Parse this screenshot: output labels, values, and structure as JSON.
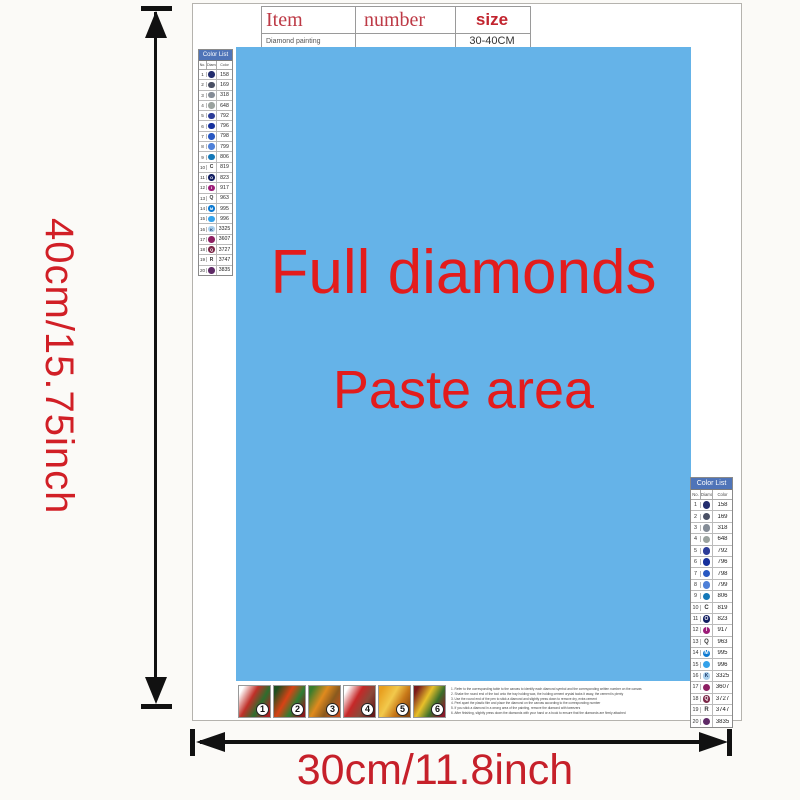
{
  "dimensions": {
    "vertical": "40cm/15.75inch",
    "horizontal": "30cm/11.8inch"
  },
  "item_table": {
    "headers": [
      "Item",
      "number",
      "size"
    ],
    "row": {
      "item": "Diamond painting",
      "number": "",
      "size": "30-40CM"
    }
  },
  "paste_area": {
    "line1": "Full diamonds",
    "line2": "Paste area",
    "bg_color": "#65b3e8",
    "text_color": "#e31c1c"
  },
  "color_list": {
    "title": "Color List",
    "header_bg": "#4f74b8",
    "columns": [
      "No.",
      "Diamond",
      "Color"
    ],
    "rows": [
      {
        "no": "1",
        "code": "158",
        "dot": "#232d6e",
        "glyph": "",
        "glyph_color": "#ffffff"
      },
      {
        "no": "2",
        "code": "169",
        "dot": "#4a5064",
        "glyph": "",
        "glyph_color": "#ffffff"
      },
      {
        "no": "3",
        "code": "318",
        "dot": "#848c96",
        "glyph": "",
        "glyph_color": "#ffffff"
      },
      {
        "no": "4",
        "code": "648",
        "dot": "#9aa29e",
        "glyph": "",
        "glyph_color": "#ffffff"
      },
      {
        "no": "5",
        "code": "792",
        "dot": "#2c3c98",
        "glyph": "",
        "glyph_color": "#ffffff"
      },
      {
        "no": "6",
        "code": "796",
        "dot": "#16309c",
        "glyph": "",
        "glyph_color": "#ffffff"
      },
      {
        "no": "7",
        "code": "798",
        "dot": "#2858c2",
        "glyph": "",
        "glyph_color": "#ffffff"
      },
      {
        "no": "8",
        "code": "799",
        "dot": "#4e80d8",
        "glyph": "",
        "glyph_color": "#ffffff"
      },
      {
        "no": "9",
        "code": "806",
        "dot": "#1478b8",
        "glyph": "",
        "glyph_color": "#ffffff"
      },
      {
        "no": "10",
        "code": "819",
        "dot": "",
        "glyph": "C",
        "glyph_color": "#333333"
      },
      {
        "no": "11",
        "code": "823",
        "dot": "#121f62",
        "glyph": "O",
        "glyph_color": "#ffffff"
      },
      {
        "no": "12",
        "code": "917",
        "dot": "#9c1c78",
        "glyph": "I",
        "glyph_color": "#ffffff"
      },
      {
        "no": "13",
        "code": "963",
        "dot": "",
        "glyph": "Q",
        "glyph_color": "#333333"
      },
      {
        "no": "14",
        "code": "995",
        "dot": "#0c7ad2",
        "glyph": "M",
        "glyph_color": "#ffffff"
      },
      {
        "no": "15",
        "code": "996",
        "dot": "#34a2ea",
        "glyph": "",
        "glyph_color": "#ffffff"
      },
      {
        "no": "16",
        "code": "3325",
        "dot": "#a9cfec",
        "glyph": "K",
        "glyph_color": "#1a3a6a"
      },
      {
        "no": "17",
        "code": "3607",
        "dot": "#8e2062",
        "glyph": "",
        "glyph_color": "#ffffff"
      },
      {
        "no": "18",
        "code": "3727",
        "dot": "#7c2848",
        "glyph": "Q",
        "glyph_color": "#ffffff"
      },
      {
        "no": "19",
        "code": "3747",
        "dot": "",
        "glyph": "R",
        "glyph_color": "#333333"
      },
      {
        "no": "20",
        "code": "3835",
        "dot": "#5e2a66",
        "glyph": "",
        "glyph_color": "#ffffff"
      }
    ]
  },
  "steps": [
    {
      "num": "1",
      "colors": [
        "#ffffff",
        "#c03028",
        "#2d6e2d",
        "#a82222"
      ]
    },
    {
      "num": "2",
      "colors": [
        "#1e4d1e",
        "#d84315",
        "#2e7d32",
        "#8b1a1a"
      ]
    },
    {
      "num": "3",
      "colors": [
        "#3a7d2d",
        "#e08a1e",
        "#8a5a1e",
        "#c24f1e"
      ]
    },
    {
      "num": "4",
      "colors": [
        "#ffffff",
        "#c62828",
        "#8a4a3a",
        "#6a1b1a"
      ]
    },
    {
      "num": "5",
      "colors": [
        "#e8a020",
        "#f2c94c",
        "#c87818",
        "#8a4a10"
      ]
    },
    {
      "num": "6",
      "colors": [
        "#7a1a1a",
        "#e8c02a",
        "#3a6e2a",
        "#8a1a2a"
      ]
    }
  ],
  "instructions": {
    "lines": [
      "1. Refer to the corresponding table to the canvas to identify each diamond symbol and the corresponding written number on the canvas",
      "2. Shake the round end of the tool onto the tray holding wax, the holding cement crystal tacks it away, the cement is plenty",
      "3. Use the round end of the pen to stick a diamond and slightly press down to remove dry, extra cement",
      "4. Peel apart the plastic film and place the diamond on the canvas according to the corresponding number",
      "5. If you stick a diamond in a wrong area of the painting, remove the diamond with tweezers",
      "6. After finishing, slightly press down the diamonds with your hand or a book to ensure that the diamonds are firmly attached"
    ]
  }
}
